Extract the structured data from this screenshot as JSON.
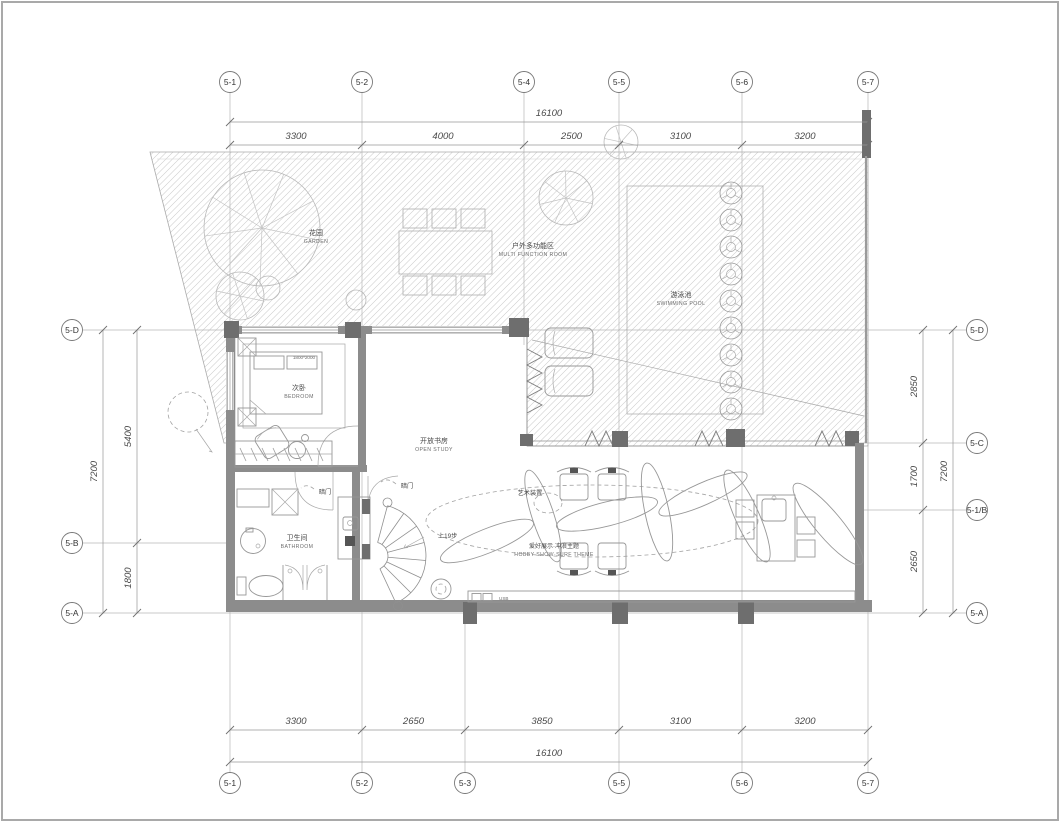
{
  "grid": {
    "top": [
      "5-1",
      "5-2",
      "5-4",
      "5-5",
      "5-6",
      "5-7"
    ],
    "bottom": [
      "5-1",
      "5-2",
      "5-3",
      "5-5",
      "5-6",
      "5-7"
    ],
    "left": [
      "5-D",
      "5-B",
      "5-A"
    ],
    "right": [
      "5-D",
      "5-C",
      "5-1/B",
      "5-A"
    ]
  },
  "dimensions": {
    "top_total": "16100",
    "top_segments": [
      "3300",
      "4000",
      "2500",
      "3100",
      "3200"
    ],
    "bottom_total": "16100",
    "bottom_segments": [
      "3300",
      "2650",
      "3850",
      "3100",
      "3200"
    ],
    "left_total": "7200",
    "left_segments": [
      "5400",
      "1800"
    ],
    "right_total": "7200",
    "right_segments": [
      "2850",
      "1700",
      "2650"
    ]
  },
  "rooms": {
    "garden": {
      "zh": "花园",
      "en": "GARDEN"
    },
    "multi_function": {
      "zh": "户外多功能区",
      "en": "MULTI FUNCTION ROOM"
    },
    "pool": {
      "zh": "游泳池",
      "en": "SWIMMING POOL"
    },
    "bedroom": {
      "zh": "次卧",
      "en": "BEDROOM"
    },
    "open_study": {
      "zh": "开放书房",
      "en": "OPEN STUDY"
    },
    "bathroom": {
      "zh": "卫生间",
      "en": "BATHROOM"
    }
  },
  "annotations": {
    "art_installation": "艺术装置",
    "hobby_theme_zh": "爱好展示·冲浪主题",
    "hobby_theme_en": "HOBBY SHOW·SURF THEME",
    "hidden_door": "暗门",
    "stair_direction": "上19步",
    "usb_label": "USB",
    "bed_size": "1800*2000"
  },
  "colors": {
    "wall": "#8c8c8c",
    "column": "#6e6e6e",
    "line": "#8f8f8f",
    "hatch": "#cccccc",
    "text": "#4d4d4d",
    "background": "#ffffff"
  }
}
